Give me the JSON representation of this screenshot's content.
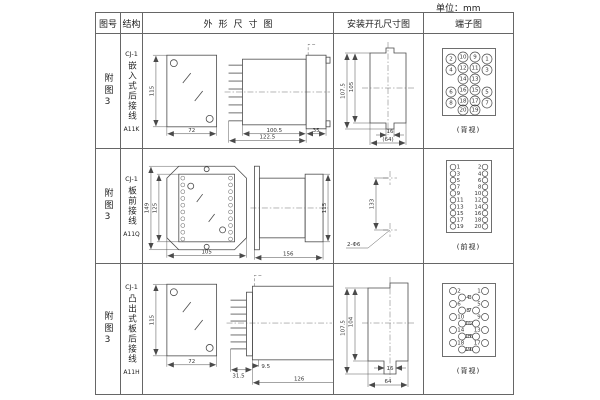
{
  "unit_label": "单位：mm",
  "header": {
    "figure": "图号",
    "structure": "结构",
    "outline": "外形尺寸图",
    "install": "安装开孔尺寸图",
    "terminal": "端子图"
  },
  "rows": [
    {
      "figure": "附图3",
      "model": "CJ-1",
      "desc": "嵌入式后接线",
      "code": "A11K",
      "outline": {
        "front_h": "115",
        "front_w": "72",
        "body_d": "100.5",
        "flange_d": "35",
        "total_d": "122.5"
      },
      "install": {
        "v_outer": "107.5",
        "v_inner": "105",
        "slot_w": "16",
        "overall_w": "(64)"
      },
      "terminal": {
        "caption": "(背视)",
        "w": 54,
        "h": 68,
        "circles": [
          {
            "x": 9,
            "y": 11,
            "r": 5,
            "n": "2"
          },
          {
            "x": 21,
            "y": 9,
            "r": 5,
            "n": "10"
          },
          {
            "x": 33,
            "y": 9,
            "r": 5,
            "n": "9"
          },
          {
            "x": 45,
            "y": 11,
            "r": 5,
            "n": "1"
          },
          {
            "x": 9,
            "y": 22,
            "r": 5,
            "n": "4"
          },
          {
            "x": 21,
            "y": 20,
            "r": 5,
            "n": "12"
          },
          {
            "x": 33,
            "y": 20,
            "r": 5,
            "n": "11"
          },
          {
            "x": 45,
            "y": 22,
            "r": 5,
            "n": "3"
          },
          {
            "x": 21,
            "y": 31,
            "r": 5,
            "n": "14"
          },
          {
            "x": 33,
            "y": 31,
            "r": 5,
            "n": "13"
          },
          {
            "x": 9,
            "y": 44,
            "r": 5,
            "n": "6"
          },
          {
            "x": 21,
            "y": 42,
            "r": 5,
            "n": "16"
          },
          {
            "x": 33,
            "y": 42,
            "r": 5,
            "n": "15"
          },
          {
            "x": 45,
            "y": 44,
            "r": 5,
            "n": "5"
          },
          {
            "x": 9,
            "y": 55,
            "r": 5,
            "n": "8"
          },
          {
            "x": 21,
            "y": 53,
            "r": 5,
            "n": "18"
          },
          {
            "x": 33,
            "y": 53,
            "r": 5,
            "n": "17"
          },
          {
            "x": 45,
            "y": 55,
            "r": 5,
            "n": "7"
          },
          {
            "x": 21,
            "y": 62,
            "r": 5,
            "n": "20"
          },
          {
            "x": 33,
            "y": 62,
            "r": 5,
            "n": "19"
          }
        ]
      }
    },
    {
      "figure": "附图3",
      "model": "CJ-1",
      "desc": "板前接线",
      "code": "A11Q",
      "outline": {
        "plate_h": "149",
        "window_h": "125",
        "plate_w": "105",
        "depth": "156",
        "case_h": "115"
      },
      "install": {
        "span": "133",
        "holes": "2-Φ6"
      },
      "terminal": {
        "caption": "(前视)",
        "w": 46,
        "h": 73,
        "circles": [
          {
            "x": 7,
            "y": 7,
            "r": 2.8,
            "n": "1",
            "np": "r"
          },
          {
            "x": 39,
            "y": 7,
            "r": 2.8,
            "n": "2",
            "np": "l"
          },
          {
            "x": 7,
            "y": 13.6,
            "r": 2.8,
            "n": "3",
            "np": "r"
          },
          {
            "x": 39,
            "y": 13.6,
            "r": 2.8,
            "n": "4",
            "np": "l"
          },
          {
            "x": 7,
            "y": 20.2,
            "r": 2.8,
            "n": "5",
            "np": "r"
          },
          {
            "x": 39,
            "y": 20.2,
            "r": 2.8,
            "n": "6",
            "np": "l"
          },
          {
            "x": 7,
            "y": 26.8,
            "r": 2.8,
            "n": "7",
            "np": "r"
          },
          {
            "x": 39,
            "y": 26.8,
            "r": 2.8,
            "n": "8",
            "np": "l"
          },
          {
            "x": 7,
            "y": 33.4,
            "r": 2.8,
            "n": "9",
            "np": "r"
          },
          {
            "x": 39,
            "y": 33.4,
            "r": 2.8,
            "n": "10",
            "np": "l"
          },
          {
            "x": 7,
            "y": 40,
            "r": 2.8,
            "n": "11",
            "np": "r"
          },
          {
            "x": 39,
            "y": 40,
            "r": 2.8,
            "n": "12",
            "np": "l"
          },
          {
            "x": 7,
            "y": 46.6,
            "r": 2.8,
            "n": "13",
            "np": "r"
          },
          {
            "x": 39,
            "y": 46.6,
            "r": 2.8,
            "n": "14",
            "np": "l"
          },
          {
            "x": 7,
            "y": 53.2,
            "r": 2.8,
            "n": "15",
            "np": "r"
          },
          {
            "x": 39,
            "y": 53.2,
            "r": 2.8,
            "n": "16",
            "np": "l"
          },
          {
            "x": 7,
            "y": 59.8,
            "r": 2.8,
            "n": "17",
            "np": "r"
          },
          {
            "x": 39,
            "y": 59.8,
            "r": 2.8,
            "n": "18",
            "np": "l"
          },
          {
            "x": 7,
            "y": 66.4,
            "r": 2.8,
            "n": "19",
            "np": "r"
          },
          {
            "x": 39,
            "y": 66.4,
            "r": 2.8,
            "n": "20",
            "np": "l"
          }
        ]
      }
    },
    {
      "figure": "附图3",
      "model": "CJ-1",
      "desc": "凸出式板后接线",
      "code": "A11H",
      "outline": {
        "front_h": "115",
        "front_w": "72",
        "comb_d": "31.5",
        "gap_d": "9.5",
        "depth": "126"
      },
      "install": {
        "v_outer": "107.5",
        "v_inner": "104",
        "slot_w": "16",
        "overall_w": "64"
      },
      "terminal": {
        "caption": "(背视)",
        "w": 54,
        "h": 74,
        "circles": [
          {
            "x": 11,
            "y": 8,
            "r": 3.5,
            "n": "2",
            "np": "r"
          },
          {
            "x": 43,
            "y": 8,
            "r": 3.5,
            "n": "1",
            "np": "l"
          },
          {
            "x": 20,
            "y": 14.5,
            "r": 3.5,
            "n": "4",
            "np": "r"
          },
          {
            "x": 34,
            "y": 14.5,
            "r": 3.5,
            "n": "3",
            "np": "l"
          },
          {
            "x": 11,
            "y": 21,
            "r": 3.5,
            "n": "6",
            "np": "r"
          },
          {
            "x": 43,
            "y": 21,
            "r": 3.5,
            "n": "5",
            "np": "l"
          },
          {
            "x": 20,
            "y": 27.5,
            "r": 3.5,
            "n": "8",
            "np": "r"
          },
          {
            "x": 34,
            "y": 27.5,
            "r": 3.5,
            "n": "7",
            "np": "l"
          },
          {
            "x": 11,
            "y": 34,
            "r": 3.5,
            "n": "10",
            "np": "r"
          },
          {
            "x": 43,
            "y": 34,
            "r": 3.5,
            "n": "9",
            "np": "l"
          },
          {
            "x": 20,
            "y": 40.5,
            "r": 3.5,
            "n": "12",
            "np": "r"
          },
          {
            "x": 34,
            "y": 40.5,
            "r": 3.5,
            "n": "11",
            "np": "l"
          },
          {
            "x": 11,
            "y": 47,
            "r": 3.5,
            "n": "14",
            "np": "r"
          },
          {
            "x": 43,
            "y": 47,
            "r": 3.5,
            "n": "13",
            "np": "l"
          },
          {
            "x": 20,
            "y": 53.5,
            "r": 3.5,
            "n": "16",
            "np": "r"
          },
          {
            "x": 34,
            "y": 53.5,
            "r": 3.5,
            "n": "15",
            "np": "l"
          },
          {
            "x": 11,
            "y": 60,
            "r": 3.5,
            "n": "18",
            "np": "r"
          },
          {
            "x": 43,
            "y": 60,
            "r": 3.5,
            "n": "17",
            "np": "l"
          },
          {
            "x": 20,
            "y": 66.5,
            "r": 3.5,
            "n": "20",
            "np": "r"
          },
          {
            "x": 34,
            "y": 66.5,
            "r": 3.5,
            "n": "19",
            "np": "l"
          }
        ]
      }
    }
  ]
}
